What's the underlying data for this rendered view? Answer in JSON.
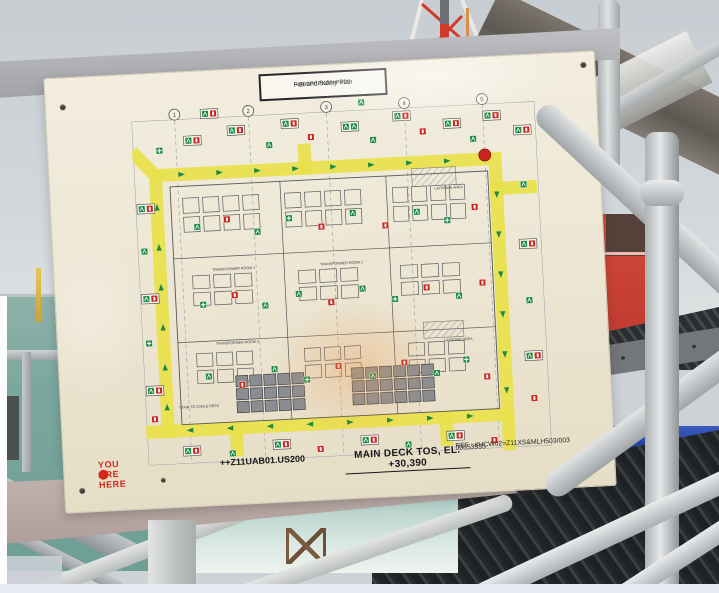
{
  "sign": {
    "header_plate": {
      "line1": "+Z00P0PK00-PK05",
      "line2": "Fire and Safety Plan"
    },
    "footer": {
      "title_line1": "MAIN DECK TOS, EL. +30,390",
      "title_line2": "++Z11UAB01.US200",
      "ref_line1": "REF : #HCW02=Z11XS&MLH503/003",
      "ref_line2": "00553935",
      "you_are_here_label": "YOU ARE HERE",
      "you_are_here_color": "#d5271c"
    }
  },
  "plan": {
    "colors": {
      "escape_route": "#e9e14b",
      "exit_green": "#1d8a44",
      "fire_red": "#c8281e",
      "drawing_line": "#55565a",
      "sheet": "#f0ebdb"
    },
    "grid_bubbles": [
      {
        "x": 44,
        "label": "1"
      },
      {
        "x": 118,
        "label": "2"
      },
      {
        "x": 196,
        "label": "3"
      },
      {
        "x": 274,
        "label": "4"
      },
      {
        "x": 352,
        "label": "5"
      }
    ],
    "route": {
      "ring": {
        "left": 22,
        "top": 68,
        "right": 362,
        "bottom": 324
      },
      "stubs": [
        [
          22,
          68,
          4,
          48
        ],
        [
          172,
          68,
          172,
          50
        ],
        [
          362,
          98,
          396,
          98
        ],
        [
          362,
          324,
          362,
          354
        ],
        [
          22,
          324,
          4,
          324
        ],
        [
          90,
          324,
          90,
          346
        ],
        [
          300,
          324,
          300,
          346
        ]
      ]
    },
    "marker": {
      "x": 352,
      "y": 64,
      "color": "#cc2420",
      "name": "red-location-marker"
    },
    "labels": [
      {
        "x": 74,
        "y": 166,
        "text": "TRANSFORMER ROOM 1"
      },
      {
        "x": 182,
        "y": 166,
        "text": "TRANSFORMER ROOM 2"
      },
      {
        "x": 74,
        "y": 240,
        "text": "TRANSFORMER ROOM 3"
      },
      {
        "x": 300,
        "y": 96,
        "text": "LAYDOWN AREA"
      },
      {
        "x": 302,
        "y": 248,
        "text": "LAYDOWN AREA"
      },
      {
        "x": 34,
        "y": 302,
        "text": "STAIR TO CABLE DECK"
      }
    ],
    "hatches": [
      {
        "x": 278,
        "y": 74,
        "w": 44,
        "h": 18
      },
      {
        "x": 282,
        "y": 228,
        "w": 40,
        "h": 16
      }
    ],
    "building": {
      "x": 36,
      "y": 80,
      "w": 318,
      "h": 238,
      "vwalls": [
        146,
        252
      ],
      "hwalls": [
        152,
        236
      ]
    },
    "clusters": [
      {
        "x": 48,
        "y": 92,
        "cols": 4,
        "rows": 2,
        "cw": 16,
        "ch": 15,
        "g": 4,
        "dark": false
      },
      {
        "x": 150,
        "y": 92,
        "cols": 4,
        "rows": 2,
        "cw": 16,
        "ch": 15,
        "g": 4,
        "dark": false
      },
      {
        "x": 258,
        "y": 92,
        "cols": 4,
        "rows": 2,
        "cw": 15,
        "ch": 15,
        "g": 4,
        "dark": false
      },
      {
        "x": 54,
        "y": 170,
        "cols": 3,
        "rows": 2,
        "cw": 17,
        "ch": 13,
        "g": 4,
        "dark": false
      },
      {
        "x": 160,
        "y": 170,
        "cols": 3,
        "rows": 2,
        "cw": 17,
        "ch": 13,
        "g": 4,
        "dark": false
      },
      {
        "x": 262,
        "y": 170,
        "cols": 3,
        "rows": 2,
        "cw": 17,
        "ch": 13,
        "g": 4,
        "dark": false
      },
      {
        "x": 54,
        "y": 248,
        "cols": 3,
        "rows": 2,
        "cw": 16,
        "ch": 13,
        "g": 4,
        "dark": false
      },
      {
        "x": 162,
        "y": 248,
        "cols": 3,
        "rows": 2,
        "cw": 16,
        "ch": 13,
        "g": 4,
        "dark": false
      },
      {
        "x": 266,
        "y": 248,
        "cols": 3,
        "rows": 2,
        "cw": 16,
        "ch": 13,
        "g": 4,
        "dark": false
      },
      {
        "x": 92,
        "y": 272,
        "cols": 5,
        "rows": 3,
        "cw": 12,
        "ch": 11,
        "g": 2,
        "dark": true
      },
      {
        "x": 208,
        "y": 270,
        "cols": 6,
        "rows": 3,
        "cw": 12,
        "ch": 11,
        "g": 2,
        "dark": true
      }
    ],
    "arrows": [
      {
        "x": 48,
        "y": 68,
        "d": "r"
      },
      {
        "x": 86,
        "y": 68,
        "d": "r"
      },
      {
        "x": 124,
        "y": 68,
        "d": "r"
      },
      {
        "x": 162,
        "y": 68,
        "d": "r"
      },
      {
        "x": 200,
        "y": 68,
        "d": "r"
      },
      {
        "x": 238,
        "y": 68,
        "d": "r"
      },
      {
        "x": 276,
        "y": 68,
        "d": "r"
      },
      {
        "x": 314,
        "y": 68,
        "d": "r"
      },
      {
        "x": 22,
        "y": 100,
        "d": "u"
      },
      {
        "x": 22,
        "y": 140,
        "d": "u"
      },
      {
        "x": 22,
        "y": 180,
        "d": "u"
      },
      {
        "x": 22,
        "y": 220,
        "d": "u"
      },
      {
        "x": 22,
        "y": 260,
        "d": "u"
      },
      {
        "x": 22,
        "y": 300,
        "d": "u"
      },
      {
        "x": 362,
        "y": 104,
        "d": "dn"
      },
      {
        "x": 362,
        "y": 144,
        "d": "dn"
      },
      {
        "x": 362,
        "y": 184,
        "d": "dn"
      },
      {
        "x": 362,
        "y": 224,
        "d": "dn"
      },
      {
        "x": 362,
        "y": 264,
        "d": "dn"
      },
      {
        "x": 362,
        "y": 300,
        "d": "dn"
      },
      {
        "x": 44,
        "y": 324,
        "d": "l"
      },
      {
        "x": 84,
        "y": 324,
        "d": "l"
      },
      {
        "x": 124,
        "y": 324,
        "d": "l"
      },
      {
        "x": 164,
        "y": 324,
        "d": "l"
      },
      {
        "x": 204,
        "y": 324,
        "d": "r"
      },
      {
        "x": 244,
        "y": 324,
        "d": "r"
      },
      {
        "x": 284,
        "y": 324,
        "d": "r"
      },
      {
        "x": 324,
        "y": 324,
        "d": "r"
      }
    ],
    "icons": [
      {
        "x": 52,
        "y": 30,
        "t": "pairEF"
      },
      {
        "x": 96,
        "y": 22,
        "t": "pairEF"
      },
      {
        "x": 134,
        "y": 40,
        "t": "exit"
      },
      {
        "x": 150,
        "y": 18,
        "t": "pairEF"
      },
      {
        "x": 176,
        "y": 34,
        "t": "fire"
      },
      {
        "x": 210,
        "y": 24,
        "t": "pairEE"
      },
      {
        "x": 238,
        "y": 40,
        "t": "exit"
      },
      {
        "x": 262,
        "y": 16,
        "t": "pairEF"
      },
      {
        "x": 288,
        "y": 34,
        "t": "fire"
      },
      {
        "x": 312,
        "y": 26,
        "t": "pairEF"
      },
      {
        "x": 338,
        "y": 44,
        "t": "exit"
      },
      {
        "x": 352,
        "y": 20,
        "t": "pairEF"
      },
      {
        "x": 24,
        "y": 40,
        "t": "aid"
      },
      {
        "x": 70,
        "y": 4,
        "t": "pairEF"
      },
      {
        "x": 228,
        "y": 2,
        "t": "exit"
      },
      {
        "x": 2,
        "y": 96,
        "t": "pairEF"
      },
      {
        "x": 4,
        "y": 140,
        "t": "exit"
      },
      {
        "x": 2,
        "y": 186,
        "t": "pairEF"
      },
      {
        "x": 4,
        "y": 232,
        "t": "aid"
      },
      {
        "x": 2,
        "y": 278,
        "t": "pairEF"
      },
      {
        "x": 6,
        "y": 308,
        "t": "fire"
      },
      {
        "x": 382,
        "y": 36,
        "t": "pairEF"
      },
      {
        "x": 386,
        "y": 92,
        "t": "exit"
      },
      {
        "x": 382,
        "y": 150,
        "t": "pairEF"
      },
      {
        "x": 386,
        "y": 208,
        "t": "exit"
      },
      {
        "x": 382,
        "y": 262,
        "t": "pairEF"
      },
      {
        "x": 386,
        "y": 306,
        "t": "fire"
      },
      {
        "x": 58,
        "y": 118,
        "t": "exit"
      },
      {
        "x": 88,
        "y": 112,
        "t": "fire"
      },
      {
        "x": 118,
        "y": 126,
        "t": "exit"
      },
      {
        "x": 150,
        "y": 114,
        "t": "aid"
      },
      {
        "x": 182,
        "y": 124,
        "t": "fire"
      },
      {
        "x": 214,
        "y": 112,
        "t": "exit"
      },
      {
        "x": 246,
        "y": 126,
        "t": "fire"
      },
      {
        "x": 278,
        "y": 114,
        "t": "exit"
      },
      {
        "x": 308,
        "y": 124,
        "t": "aid"
      },
      {
        "x": 336,
        "y": 112,
        "t": "fire"
      },
      {
        "x": 60,
        "y": 196,
        "t": "aid"
      },
      {
        "x": 92,
        "y": 188,
        "t": "fire"
      },
      {
        "x": 122,
        "y": 200,
        "t": "exit"
      },
      {
        "x": 156,
        "y": 190,
        "t": "exit"
      },
      {
        "x": 188,
        "y": 200,
        "t": "fire"
      },
      {
        "x": 220,
        "y": 188,
        "t": "exit"
      },
      {
        "x": 252,
        "y": 200,
        "t": "aid"
      },
      {
        "x": 284,
        "y": 190,
        "t": "fire"
      },
      {
        "x": 316,
        "y": 200,
        "t": "exit"
      },
      {
        "x": 340,
        "y": 188,
        "t": "fire"
      },
      {
        "x": 62,
        "y": 268,
        "t": "exit"
      },
      {
        "x": 95,
        "y": 278,
        "t": "fire"
      },
      {
        "x": 128,
        "y": 264,
        "t": "exit"
      },
      {
        "x": 160,
        "y": 276,
        "t": "aid"
      },
      {
        "x": 192,
        "y": 264,
        "t": "fire"
      },
      {
        "x": 226,
        "y": 276,
        "t": "exit"
      },
      {
        "x": 258,
        "y": 264,
        "t": "fire"
      },
      {
        "x": 290,
        "y": 276,
        "t": "exit"
      },
      {
        "x": 320,
        "y": 264,
        "t": "aid"
      },
      {
        "x": 340,
        "y": 282,
        "t": "fire"
      },
      {
        "x": 36,
        "y": 340,
        "t": "pairEF"
      },
      {
        "x": 82,
        "y": 346,
        "t": "exit"
      },
      {
        "x": 126,
        "y": 338,
        "t": "pairEF"
      },
      {
        "x": 170,
        "y": 346,
        "t": "fire"
      },
      {
        "x": 214,
        "y": 338,
        "t": "pairEF"
      },
      {
        "x": 258,
        "y": 346,
        "t": "exit"
      },
      {
        "x": 300,
        "y": 338,
        "t": "pairEF"
      },
      {
        "x": 344,
        "y": 346,
        "t": "fire"
      }
    ]
  },
  "background": {
    "colors": {
      "sky": "#ccd2d6",
      "sea": "#7aa79d",
      "tower_red": "#d23b2c",
      "container_blue": "#203f9c",
      "container_orange": "#dd5a2a",
      "railing_grey": "#c9cccd",
      "beam_dark": "#5d5852"
    }
  }
}
